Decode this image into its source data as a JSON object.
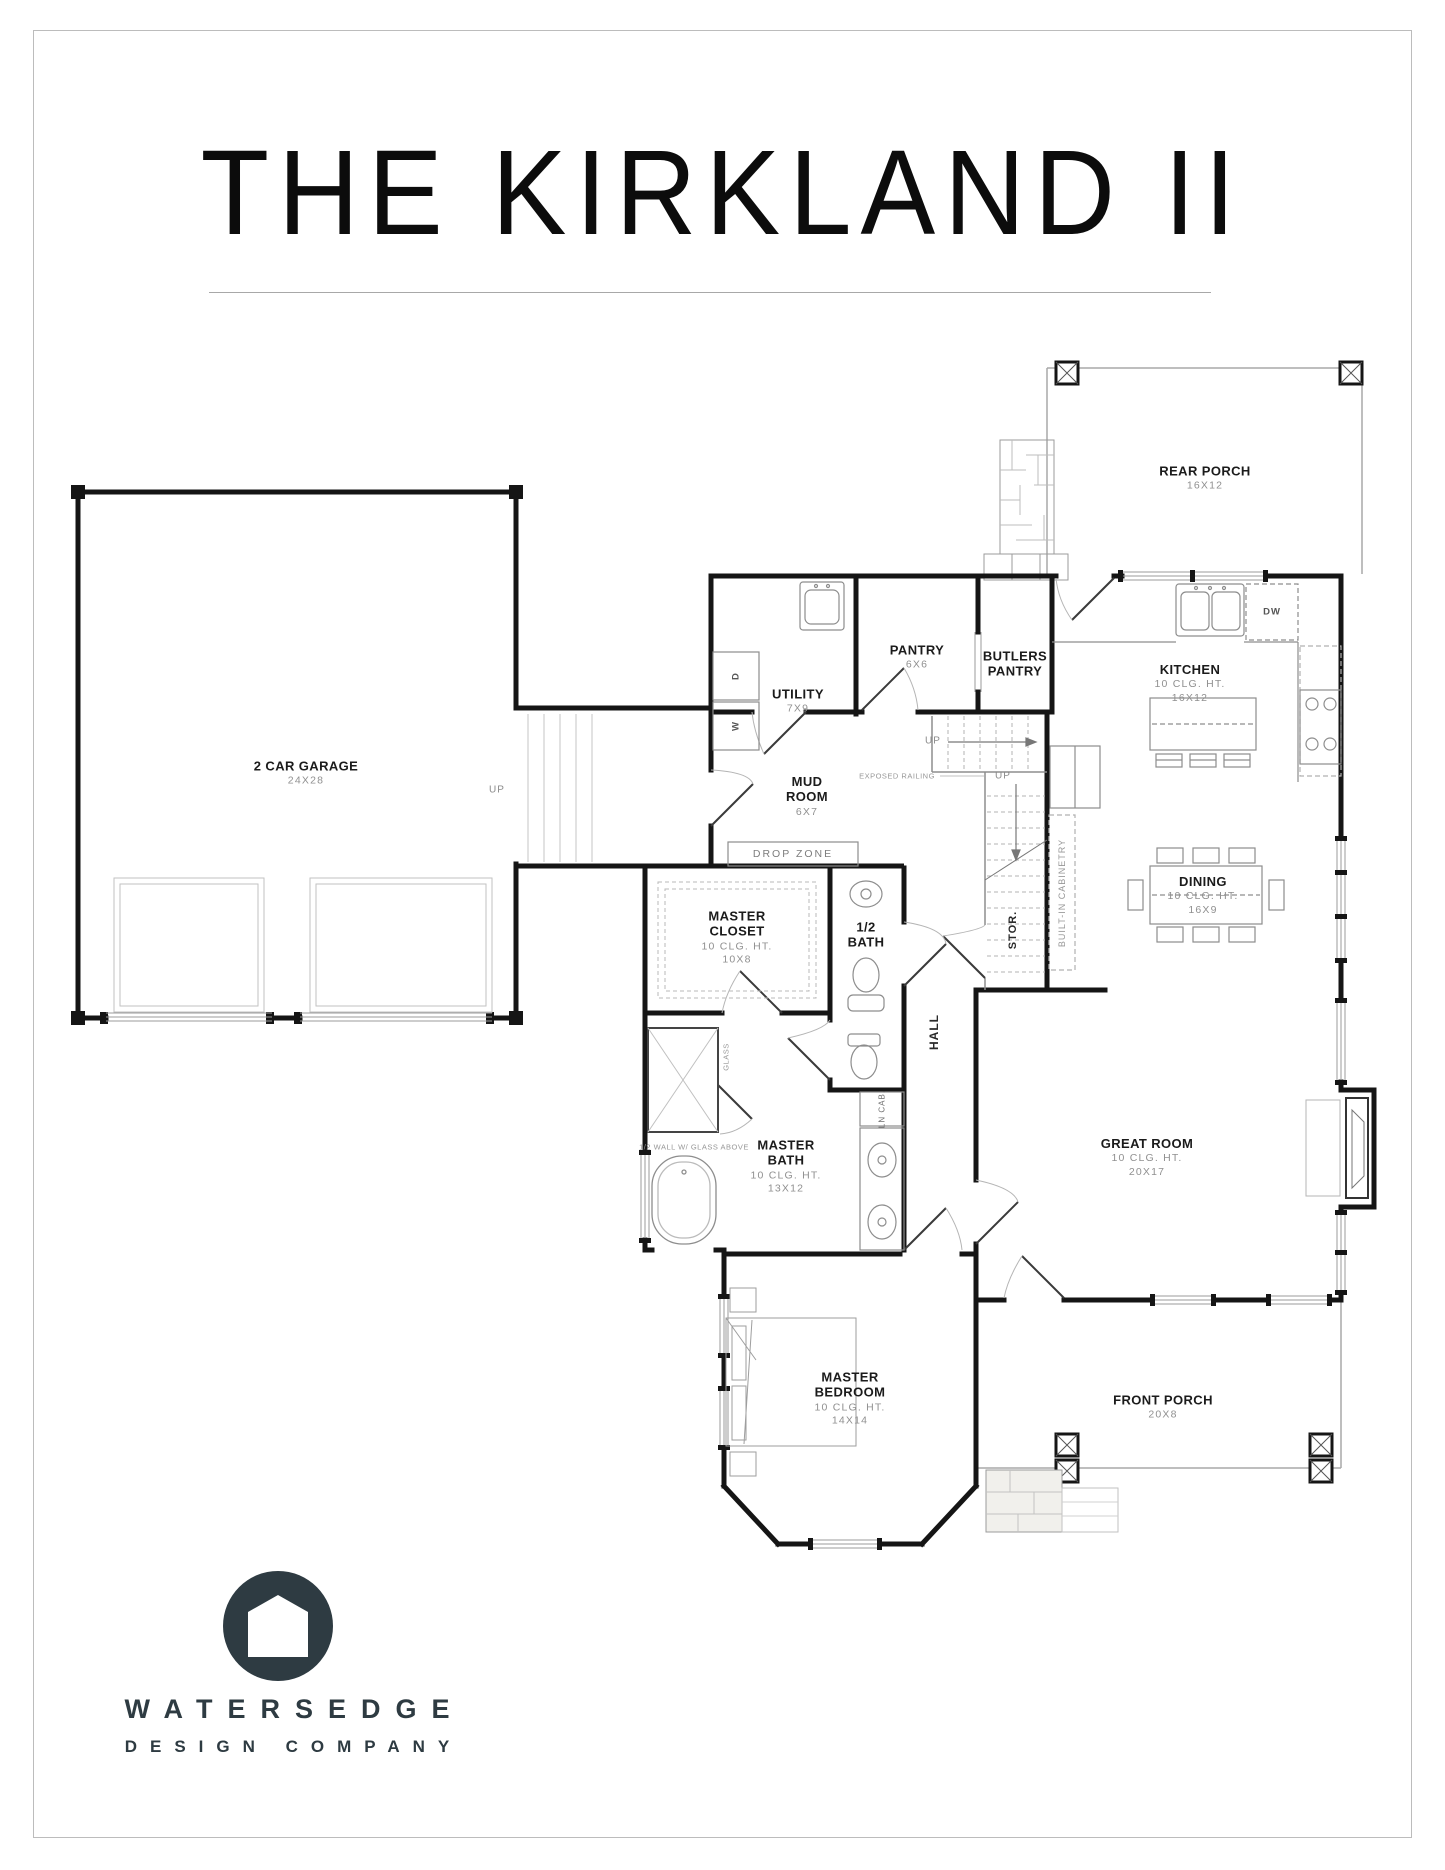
{
  "page": {
    "title": "THE KIRKLAND II"
  },
  "rooms": [
    {
      "name": "REAR PORCH",
      "dims": "16X12"
    },
    {
      "name": "KITCHEN",
      "clg": "10 CLG. HT.",
      "dims": "16X12"
    },
    {
      "name": "PANTRY",
      "dims": "6X6"
    },
    {
      "name": "BUTLERS PANTRY"
    },
    {
      "name": "UTILITY",
      "dims": "7X9"
    },
    {
      "name": "MUD ROOM",
      "dims": "6X7"
    },
    {
      "name": "2 CAR GARAGE",
      "dims": "24X28"
    },
    {
      "name": "DINING",
      "clg": "10 CLG. HT.",
      "dims": "16X9"
    },
    {
      "name": "MASTER CLOSET",
      "clg": "10 CLG. HT.",
      "dims": "10X8"
    },
    {
      "name": "1/2 BATH"
    },
    {
      "name": "GREAT ROOM",
      "clg": "10 CLG. HT.",
      "dims": "20X17"
    },
    {
      "name": "MASTER BATH",
      "clg": "10 CLG. HT.",
      "dims": "13X12"
    },
    {
      "name": "MASTER BEDROOM",
      "clg": "10 CLG. HT.",
      "dims": "14X14"
    },
    {
      "name": "FRONT PORCH",
      "dims": "20X8"
    }
  ],
  "notes": {
    "drop_zone": "DROP ZONE",
    "exposed_railing": "EXPOSED RAILING",
    "built_in": "BUILT-IN CABINETRY",
    "stor": "STOR.",
    "hall": "HALL",
    "glass": "GLASS",
    "half_wall": "1/2 WALL W/ GLASS ABOVE",
    "ln_cab": "LN CAB.",
    "up": "UP",
    "w": "W",
    "d": "D",
    "dw": "DW"
  },
  "logo": {
    "name": "WATERSEDGE",
    "tagline": "DESIGN COMPANY"
  },
  "colors": {
    "wall": "#151515",
    "fixture": "#8d8d8d",
    "dim_text": "#909090",
    "logo": "#2e3b42"
  }
}
